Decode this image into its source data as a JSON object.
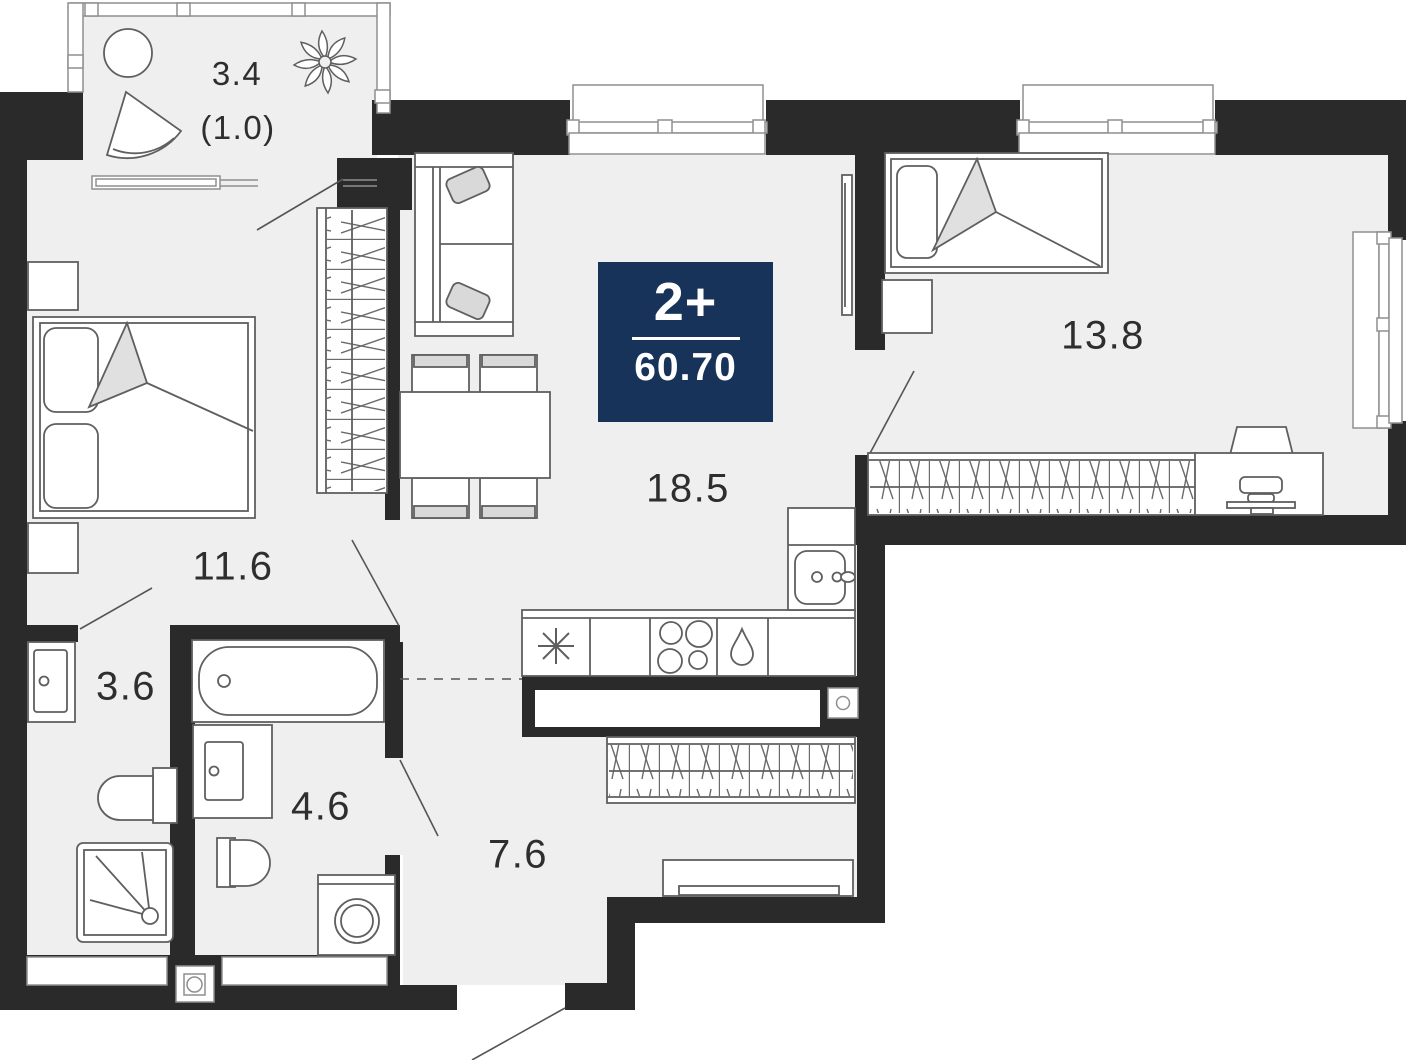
{
  "plan": {
    "badge": {
      "rooms": "2+",
      "area": "60.70"
    },
    "rooms": [
      {
        "key": "balcony",
        "area": "3.4",
        "area_coefficient": "(1.0)"
      },
      {
        "key": "bedroom",
        "area": "11.6"
      },
      {
        "key": "living-kitchen",
        "area": "18.5"
      },
      {
        "key": "bedroom-2",
        "area": "13.8"
      },
      {
        "key": "bathroom",
        "area": "3.6"
      },
      {
        "key": "bathroom-2",
        "area": "4.6"
      },
      {
        "key": "hallway",
        "area": "7.6"
      }
    ],
    "colors": {
      "wall": "#2a2a2a",
      "floor": "#efefef",
      "badge_bg": "#17335a",
      "badge_text": "#ffffff",
      "outline": "#5f5f5f"
    }
  }
}
